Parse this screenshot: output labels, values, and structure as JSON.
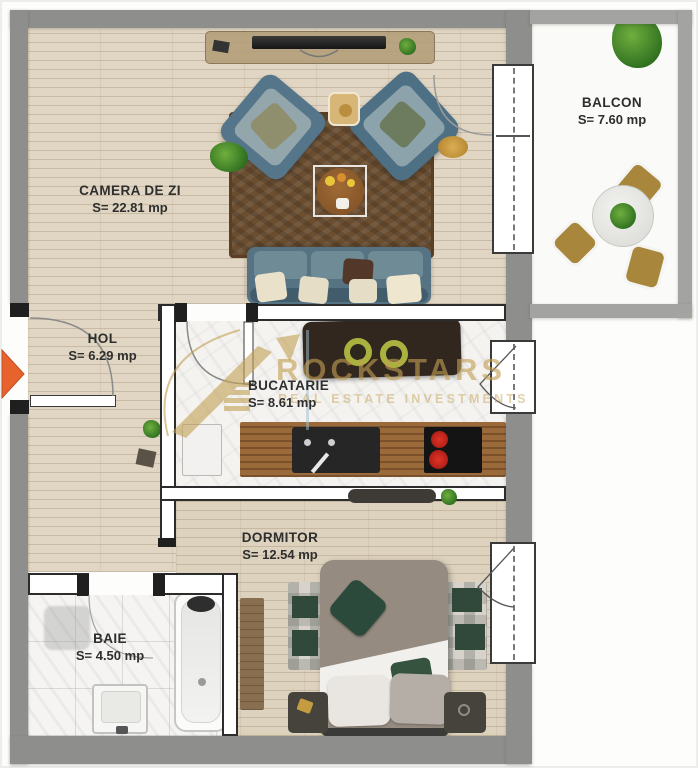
{
  "plan": {
    "type": "Apartment floor plan",
    "rooms": {
      "living": {
        "name": "CAMERA DE ZI",
        "area": "S= 22.81 mp"
      },
      "balcony": {
        "name": "BALCON",
        "area": "S= 7.60 mp"
      },
      "hall": {
        "name": "HOL",
        "area": "S= 6.29 mp"
      },
      "kitchen": {
        "name": "BUCATARIE",
        "area": "S= 8.61 mp"
      },
      "bedroom": {
        "name": "DORMITOR",
        "area": "S= 12.54 mp"
      },
      "bathroom": {
        "name": "BAIE",
        "area": "S= 4.50 mp"
      }
    }
  },
  "watermark": {
    "brand": "ROCKSTARS",
    "tagline": "REAL ESTATE INVESTMENTS",
    "color": "#c29e52"
  },
  "palette": {
    "outer_wall": "#8e8e8c",
    "balcony_wall": "#a3a3a1",
    "wood_floor": "#e0d6c3",
    "marble_floor": "#f4f3f0",
    "sofa_blue": "#567383",
    "rug_brown": "#6b4e30",
    "entrance_arrow": "#e8622d",
    "burner_red": "#c42620"
  }
}
